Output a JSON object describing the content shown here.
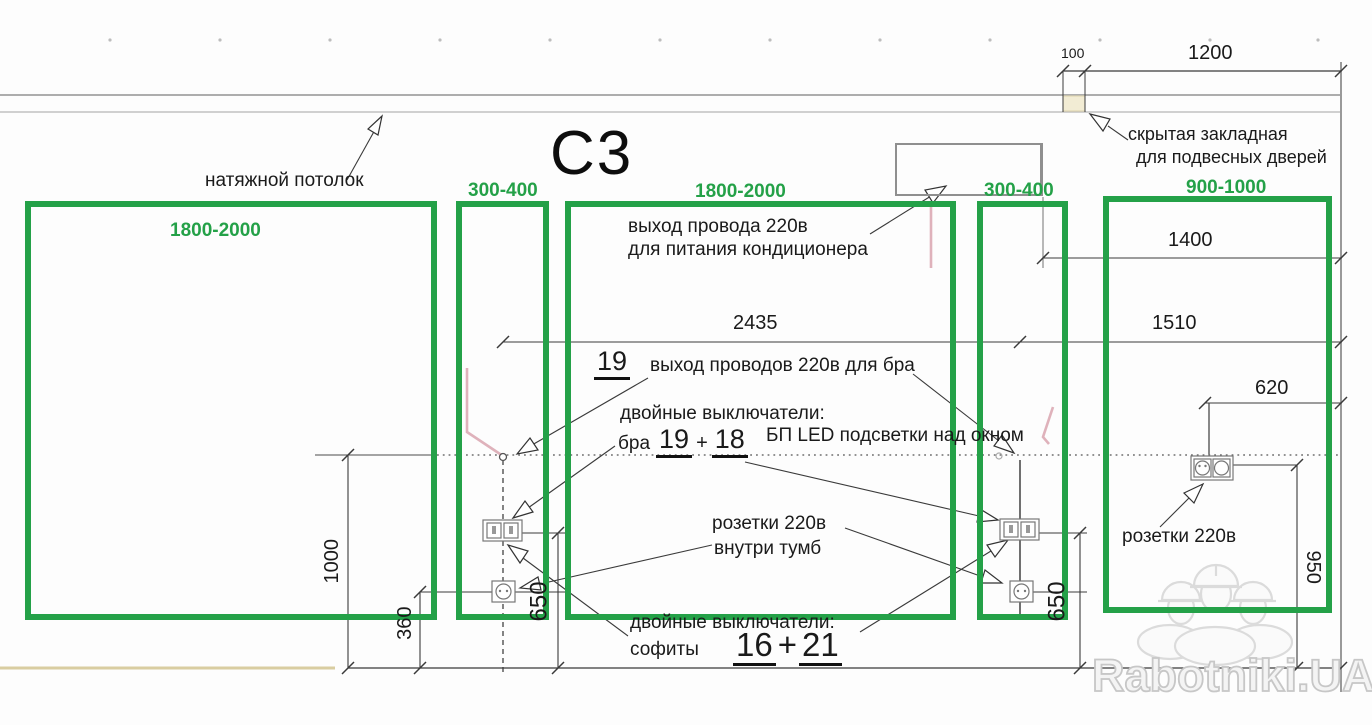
{
  "drawing": {
    "title": "С3",
    "watermark": "Rabotniki.UA"
  },
  "zones": [
    {
      "label": "1800-2000"
    },
    {
      "label": "300-400"
    },
    {
      "label": "1800-2000"
    },
    {
      "label": "300-400"
    },
    {
      "label": "900-1000"
    }
  ],
  "dimensions": {
    "top_offset": "100",
    "top_width": "1200",
    "wall_span": "2435",
    "right_top": "1400",
    "right_mid": "1510",
    "right_small": "620",
    "left_height": "1000",
    "left_offset": "360",
    "switch_height_left": "650",
    "switch_height_right": "650",
    "socket_height_right": "950"
  },
  "labels": {
    "ceiling": "натяжной потолок",
    "hidden_mount": [
      "скрытая закладная",
      "для подвесных дверей"
    ],
    "ac_wire": [
      "выход провода 220в",
      "для питания кондиционера"
    ],
    "bra_wire_num": "19",
    "bra_wire": "выход проводов 220в для бра",
    "switches_bra_title": "двойные выключатели:",
    "bra": "бра",
    "bra_n1": "19",
    "plus": "+",
    "bra_n2": "18",
    "led_psu": "БП  LED подсветки над окном",
    "sockets_cab": [
      "розетки 220в",
      "внутри  тумб"
    ],
    "switches_soffits_title": "двойные выключатели:",
    "soffits": "софиты",
    "soffit_n1": "16",
    "soffit_n2": "21",
    "sockets_right": "розетки 220в"
  },
  "colors": {
    "zone_green": "#24a148",
    "pink": "#dcaab4",
    "floor_tan": "#d9cda1",
    "line": "#3a3a3a"
  }
}
